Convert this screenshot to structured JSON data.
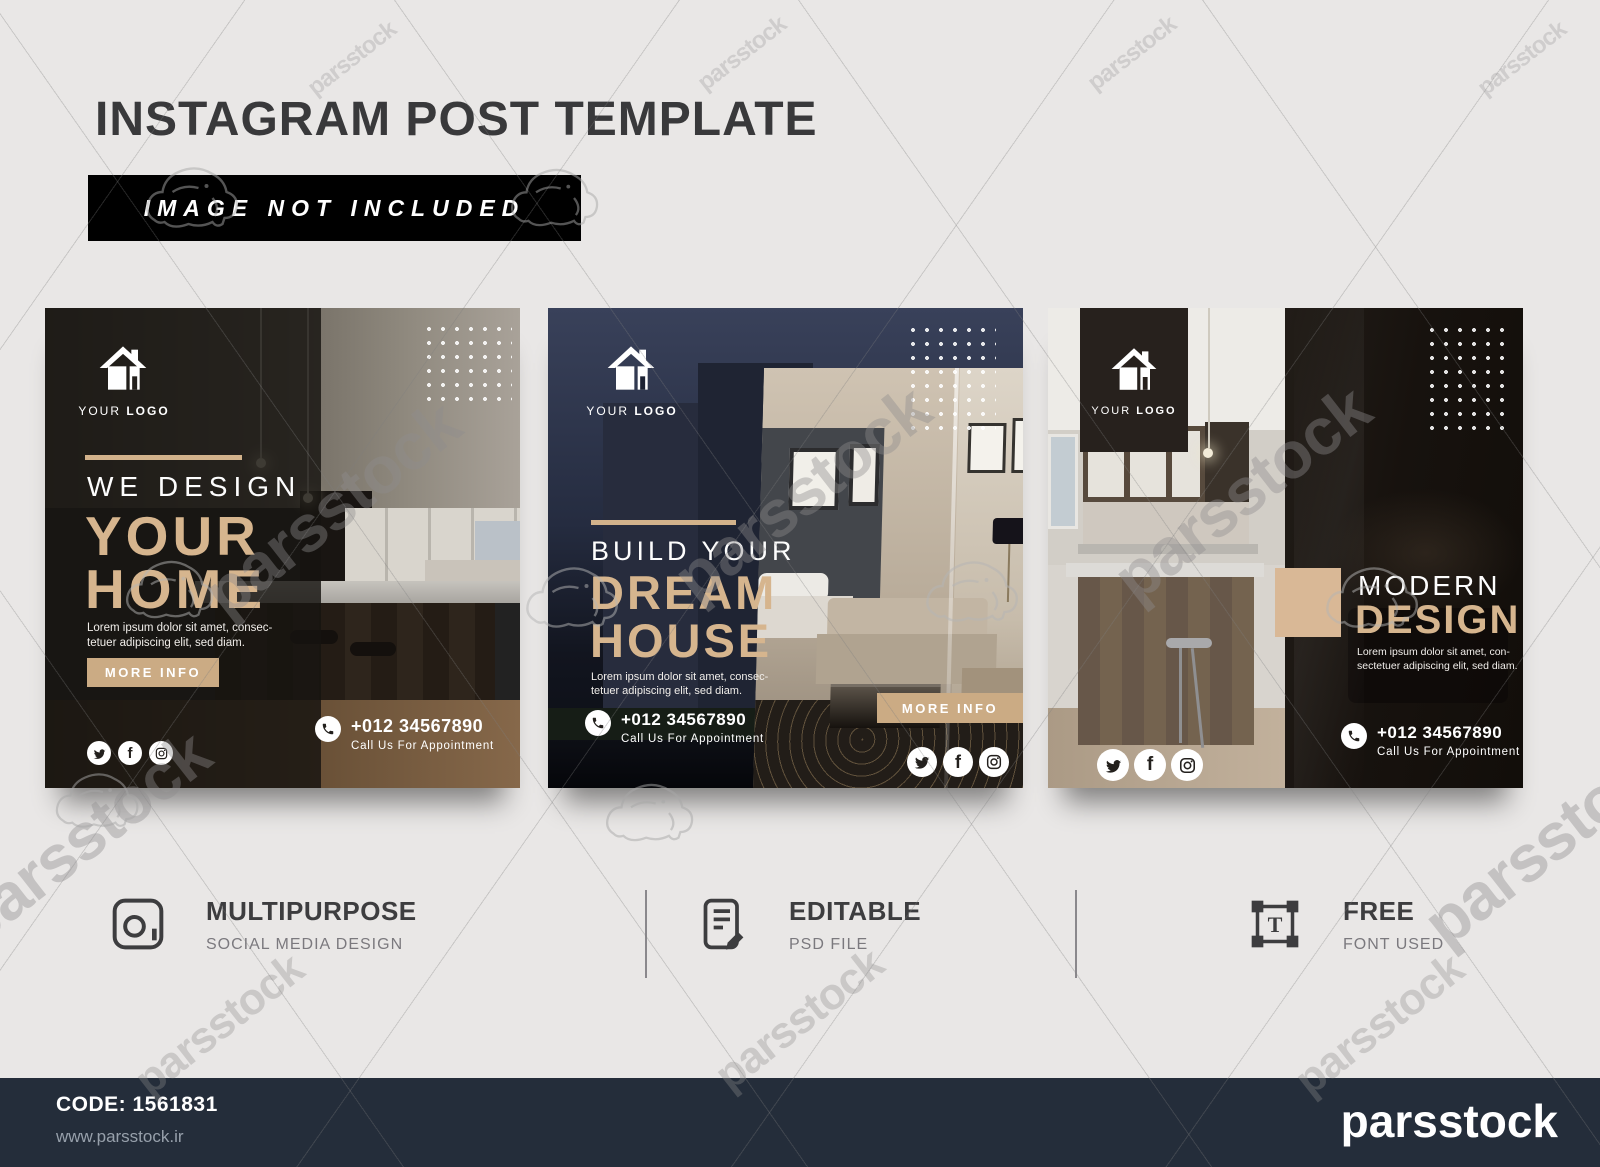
{
  "header": {
    "title": "INSTAGRAM POST TEMPLATE",
    "banner": "IMAGE NOT INCLUDED"
  },
  "watermark": {
    "text": "parsstock"
  },
  "cards": [
    {
      "logo_your": "YOUR",
      "logo_logo": "LOGO",
      "kicker": "WE DESIGN",
      "title_line1": "YOUR",
      "title_line2": "HOME",
      "body_line1": "Lorem ipsum dolor sit amet, consec-",
      "body_line2": "tetuer adipiscing elit, sed diam.",
      "button": "MORE INFO",
      "phone": "+012 34567890",
      "phone_caption": "Call Us For Appointment"
    },
    {
      "logo_your": "YOUR",
      "logo_logo": "LOGO",
      "kicker": "BUILD YOUR",
      "title_line1": "DREAM",
      "title_line2": "HOUSE",
      "body_line1": "Lorem ipsum dolor sit amet, consec-",
      "body_line2": "tetuer adipiscing elit, sed diam.",
      "button": "MORE INFO",
      "phone": "+012 34567890",
      "phone_caption": "Call Us For Appointment"
    },
    {
      "logo_your": "YOUR",
      "logo_logo": "LOGO",
      "kicker": "MODERN",
      "title_line1": "DESIGN",
      "body_line1": "Lorem ipsum dolor sit amet, con-",
      "body_line2": "sectetuer adipiscing elit, sed diam.",
      "phone": "+012 34567890",
      "phone_caption": "Call Us For Appointment"
    }
  ],
  "features": [
    {
      "title": "MULTIPURPOSE",
      "subtitle": "SOCIAL MEDIA DESIGN",
      "icon": "camera-frame-icon"
    },
    {
      "title": "EDITABLE",
      "subtitle": "PSD FILE",
      "icon": "document-edit-icon"
    },
    {
      "title": "FREE",
      "subtitle": "FONT USED",
      "icon": "text-frame-icon"
    }
  ],
  "footer": {
    "code": "CODE: 1561831",
    "website": "www.parsstock.ir",
    "brand": "parsstock"
  },
  "icons": {
    "logo": "house-icon",
    "social": [
      "twitter-icon",
      "facebook-icon",
      "instagram-icon"
    ],
    "contact": "phone-icon"
  },
  "colors": {
    "accent_tan": "#d2b28b",
    "page_bg": "#e9e7e6",
    "banner_bg": "#000000",
    "title_color": "#39393b",
    "footer_bg": "#242d3a",
    "card2_navy": "#252c40",
    "card3_dark": "#17120e"
  }
}
